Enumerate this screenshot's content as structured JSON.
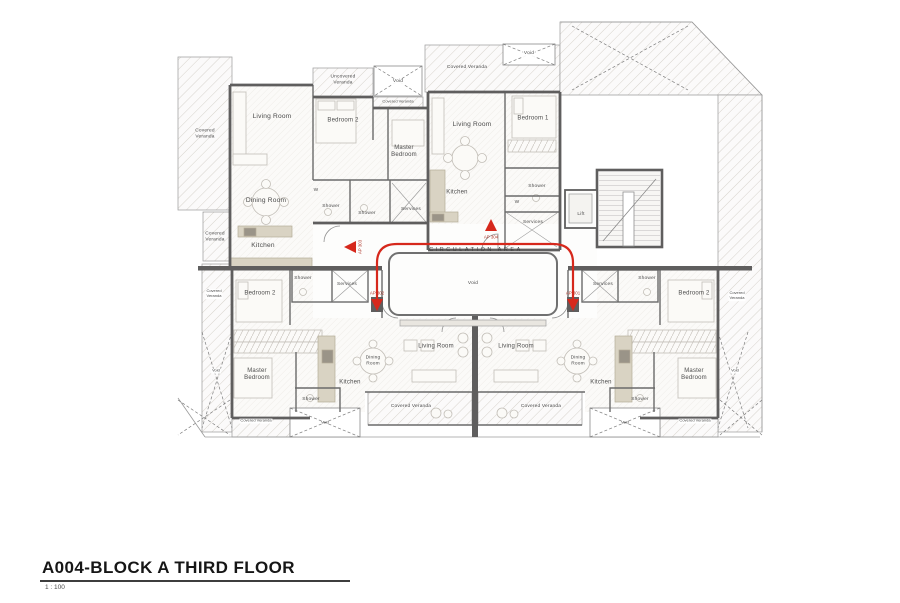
{
  "colors": {
    "path_red": "#d6281c",
    "wall_gray": "#5f5e5e"
  },
  "title_block": {
    "title": "A004-BLOCK A THIRD FLOOR",
    "scale": "1 : 100"
  },
  "core": {
    "circulation": "CIRCULATION  AREA",
    "void": "Void",
    "lift": "Lift"
  },
  "units": {
    "ap301": "AP 301",
    "ap302": "AP 302",
    "ap303": "AP 303",
    "ap304": "AP 304"
  },
  "ap303": {
    "living": "Living Room",
    "bedroom2": "Bedroom 2",
    "master": "Master\nBedroom",
    "dining": "Dining Room",
    "kitchen": "Kitchen",
    "laundry": "W",
    "shower_a": "Shower",
    "shower_b": "Shower",
    "services": "Services",
    "veranda_big": "Covered\nVeranda",
    "veranda_small": "Covered\nVeranda",
    "uncovered_veranda": "Uncovered\nVeranda",
    "veranda_strip": "Covered Veranda",
    "void": "Void"
  },
  "ap304": {
    "living": "Living Room",
    "bedroom1": "Bedroom 1",
    "kitchen": "Kitchen",
    "laundry": "W",
    "shower": "Shower",
    "services": "Services",
    "veranda": "Covered Veranda",
    "void": "Void"
  },
  "ap302": {
    "living": "Living Room",
    "bedroom2": "Bedroom 2",
    "master": "Master\nBedroom",
    "dining": "Dining\nRoom",
    "kitchen": "Kitchen",
    "shower_a": "Shower",
    "shower_b": "Shower",
    "services": "Services",
    "veranda_side": "Covered\nVeranda",
    "veranda_center": "Covered Veranda",
    "veranda_outer": "Covered Veranda",
    "void_side": "Void",
    "void_box": "Void"
  },
  "ap301": {
    "living": "Living Room",
    "bedroom2": "Bedroom 2",
    "master": "Master\nBedroom",
    "dining": "Dining\nRoom",
    "kitchen": "Kitchen",
    "shower_a": "Shower",
    "shower_b": "Shower",
    "services": "Services",
    "veranda_side": "Covered\nVeranda",
    "veranda_center": "Covered Veranda",
    "veranda_outer": "Covered Veranda",
    "void_side": "Void",
    "void_box": "Void"
  }
}
